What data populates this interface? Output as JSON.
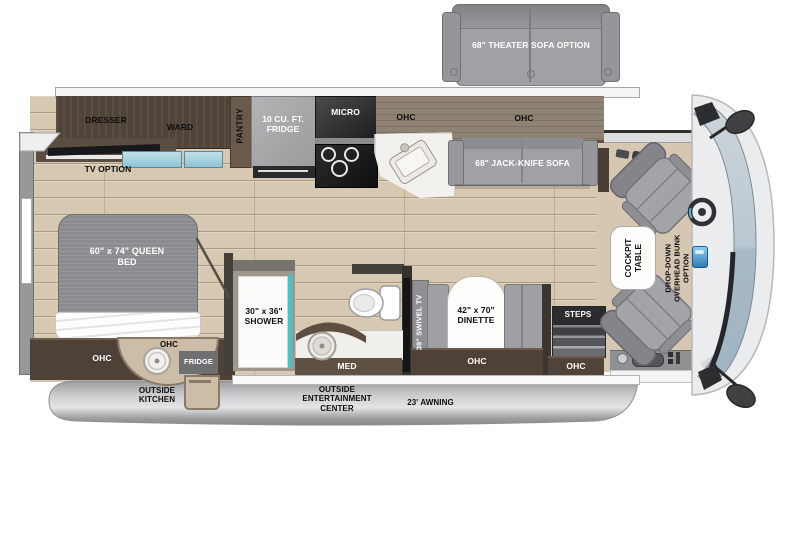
{
  "labels": {
    "theater_sofa_option": "68\" THEATER SOFA OPTION",
    "dresser": "DRESSER",
    "ward": "WARD",
    "pantry": "PANTRY",
    "refrigerator": "10 CU. FT. FRIDGE",
    "micro": "MICRO",
    "ohc": "OHC",
    "jack_knife_sofa": "68\" JACK-KNIFE SOFA",
    "tv_option": "TV OPTION",
    "queen_bed": "60\" x 74\" QUEEN BED",
    "outside_fridge": "FRIDGE",
    "outside_kitchen": "OUTSIDE KITCHEN",
    "shower": "30\" x 36\" SHOWER",
    "med": "MED",
    "swivel_tv": "39\" SWIVEL TV",
    "dinette": "42\" x 70\" DINETTE",
    "steps": "STEPS",
    "outside_entertainment_center": "OUTSIDE ENTERTAINMENT CENTER",
    "awning": "23' AWNING",
    "cockpit_table": "COCKPIT TABLE",
    "overhead_bunk": "DROP-DOWN OVERHEAD BUNK OPTION"
  },
  "colors": {
    "dark_cabinet": "#50443a",
    "light_wood_cabinet": "#8e8273",
    "floor_wood": "#d7c8b2",
    "cab_floor": "#d6c7b2",
    "upholstery_gray": "#9fa0a3",
    "appliance_gray": "#a8a8aa",
    "skirt_silver": "#c6c7c9",
    "windshield_blue": "#b6c5d0",
    "shower_glass_teal": "#3fc6c6",
    "drawer_blue": "#a9d2e0"
  }
}
